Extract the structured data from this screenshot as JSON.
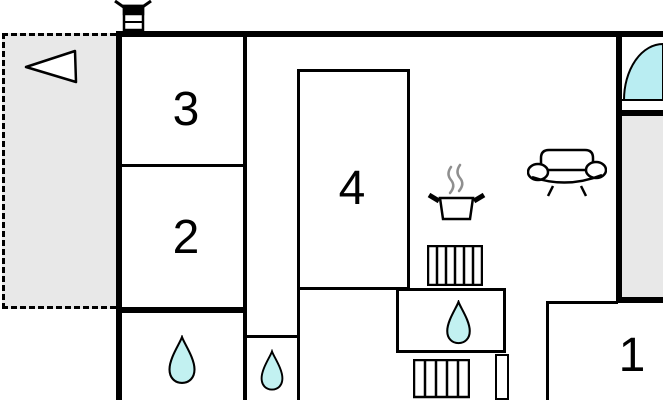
{
  "floorplan": {
    "title": "apartment-floor-plan",
    "rooms": [
      {
        "id": "room-1",
        "label": "1"
      },
      {
        "id": "room-2",
        "label": "2"
      },
      {
        "id": "room-3",
        "label": "3"
      },
      {
        "id": "room-4",
        "label": "4"
      }
    ],
    "icons": [
      "chimney-icon",
      "direction-triangle-icon",
      "window-arc-icon",
      "cooking-pot-icon",
      "sofa-icon",
      "radiator-icon",
      "water-drop-icon"
    ],
    "colors": {
      "wall": "#000000",
      "terrace_fill": "#e8e8e8",
      "water": "#c2f1f1",
      "window_arc": "#b9edf2",
      "steam": "#8f8f8f",
      "background": "#ffffff"
    }
  }
}
